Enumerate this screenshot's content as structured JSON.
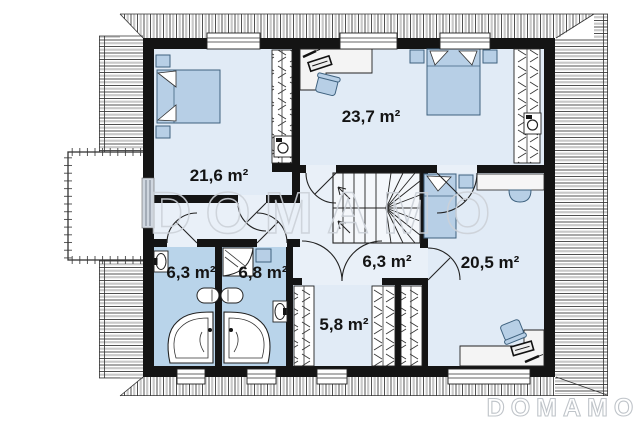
{
  "title": "attic-floor-plan",
  "watermarks": {
    "center": "DOMAMO",
    "bottom": "DOMAMO"
  },
  "rooms": [
    {
      "id": "bedroom-top-left",
      "area_label": "21,6 m²"
    },
    {
      "id": "bedroom-top-right",
      "area_label": "23,7 m²"
    },
    {
      "id": "bathroom-left",
      "area_label": "6,3 m²"
    },
    {
      "id": "bathroom-right",
      "area_label": "6,8 m²"
    },
    {
      "id": "hall",
      "area_label": "6,3 m²"
    },
    {
      "id": "walk-in-closet",
      "area_label": "5,8 m²"
    },
    {
      "id": "bedroom-bottom-right",
      "area_label": "20,5 m²"
    }
  ],
  "icons": [
    "double-bed-icon",
    "single-bed-icon",
    "nightstand-icon",
    "desk-icon",
    "office-chair-icon",
    "keyboard-icon",
    "pen-icon",
    "wardrobe-icon",
    "washing-machine-icon",
    "stairs-icon",
    "bathtub-icon",
    "sink-icon",
    "shower-cabin-icon",
    "radiator-icon",
    "balcony",
    "roof-overhang",
    "window",
    "door-arc",
    "vanity-sink-icon"
  ],
  "colors": {
    "wall": "#141414",
    "floor": "#e9f0f8",
    "bedroomFloor": "#e1ebf6",
    "bathFloor": "#b9d4ea",
    "furn": "#b7cfe6",
    "furnStroke": "#3f627f",
    "watermark": "#ccd1d8",
    "watermarkBottom": "#b9bec4",
    "hatch": "#3c3c3c"
  }
}
